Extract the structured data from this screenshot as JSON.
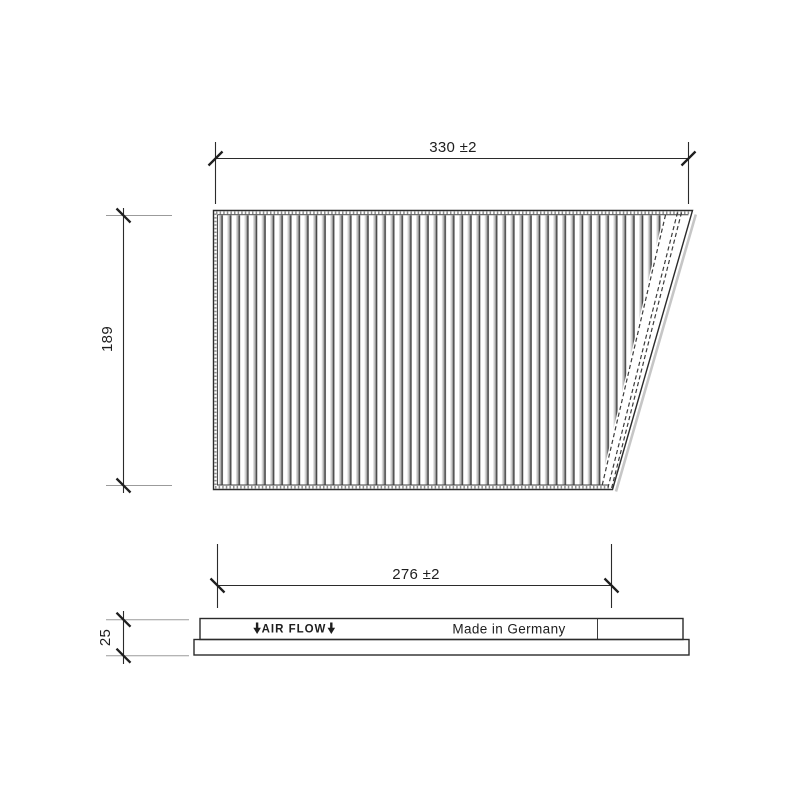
{
  "document_type": "technical-drawing",
  "part": "pleated cabin air filter panel",
  "colors": {
    "background": "#ffffff",
    "main_line": "#2b2b2b",
    "aux_line": "#9b9b9b",
    "pleat_dark": "#474747",
    "pleat_gray": "#b9b9b9",
    "stipple_gray": "#8e8e8e",
    "shadow_gray": "#c6c6c6"
  },
  "dimensions": {
    "overall_width": {
      "label": "330 ±2",
      "value_mm": 330,
      "tolerance_mm": 2
    },
    "overall_height": {
      "label": "189",
      "value_mm": 189
    },
    "pack_width": {
      "label": "276 ±2",
      "value_mm": 276,
      "tolerance_mm": 2
    },
    "thickness": {
      "label": "25",
      "value_mm": 25
    }
  },
  "side_view": {
    "air_flow_label": "AIR FLOW",
    "made_in_label": "Made in Germany"
  }
}
